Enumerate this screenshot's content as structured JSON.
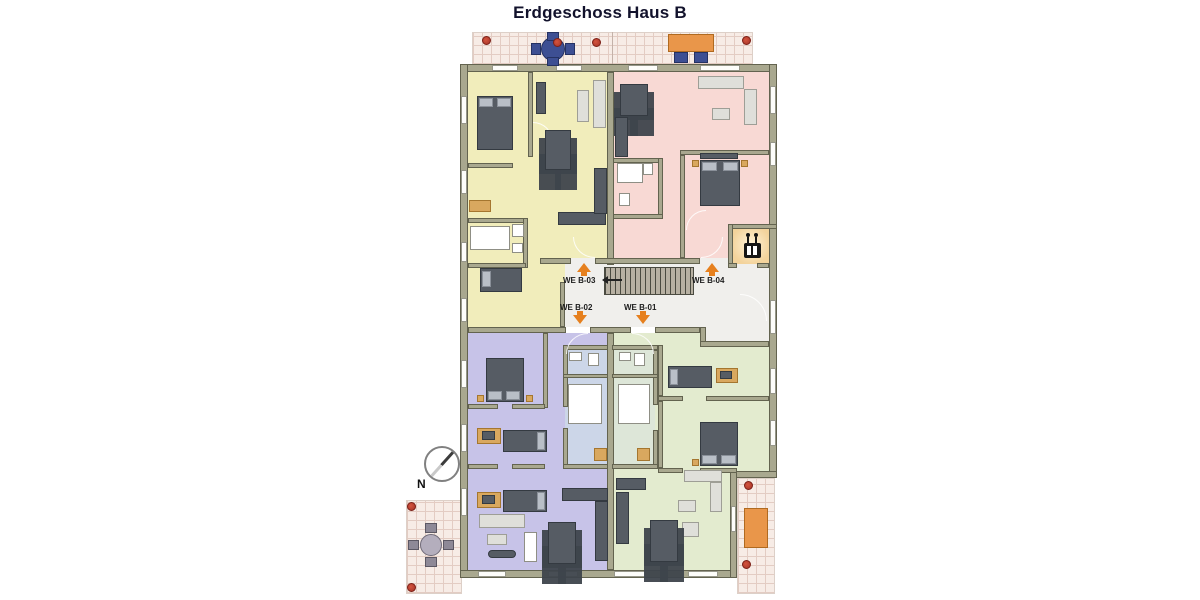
{
  "title": "Erdgeschoss Haus B",
  "compass": {
    "label": "N"
  },
  "units": [
    {
      "id": "we-b-03",
      "label": "WE B-03",
      "arrow": "up",
      "color_key": "yellow"
    },
    {
      "id": "we-b-04",
      "label": "WE B-04",
      "arrow": "up",
      "color_key": "pink"
    },
    {
      "id": "we-b-02",
      "label": "WE B-02",
      "arrow": "down",
      "color_key": "purple"
    },
    {
      "id": "we-b-01",
      "label": "WE B-01",
      "arrow": "down",
      "color_key": "green"
    }
  ],
  "icons": {
    "elevator": "elevator-icon",
    "stairs": "staircase",
    "compass": "compass-north-icon"
  },
  "colors": {
    "wall": "#a9a88f",
    "wallline": "#63634f",
    "yellow": "#f1edbb",
    "pink": "#f8d9d4",
    "purple": "#c7c3e8",
    "green": "#e3ebcf",
    "hall": "#f0efec",
    "bathblue": "#ccd6e8",
    "bathgreen": "#dde6d8",
    "tile": "#f7ece6",
    "tileline": "#e3ccc3",
    "elev": "#f3d39b",
    "arrow": "#e6801e",
    "dark": "#565c64",
    "light": "#dfdfda",
    "wood": "#d9a85f",
    "blue": "#3d4f93",
    "orange": "#e9964a",
    "red": "#a33327",
    "stair": "#b7b0a2"
  }
}
